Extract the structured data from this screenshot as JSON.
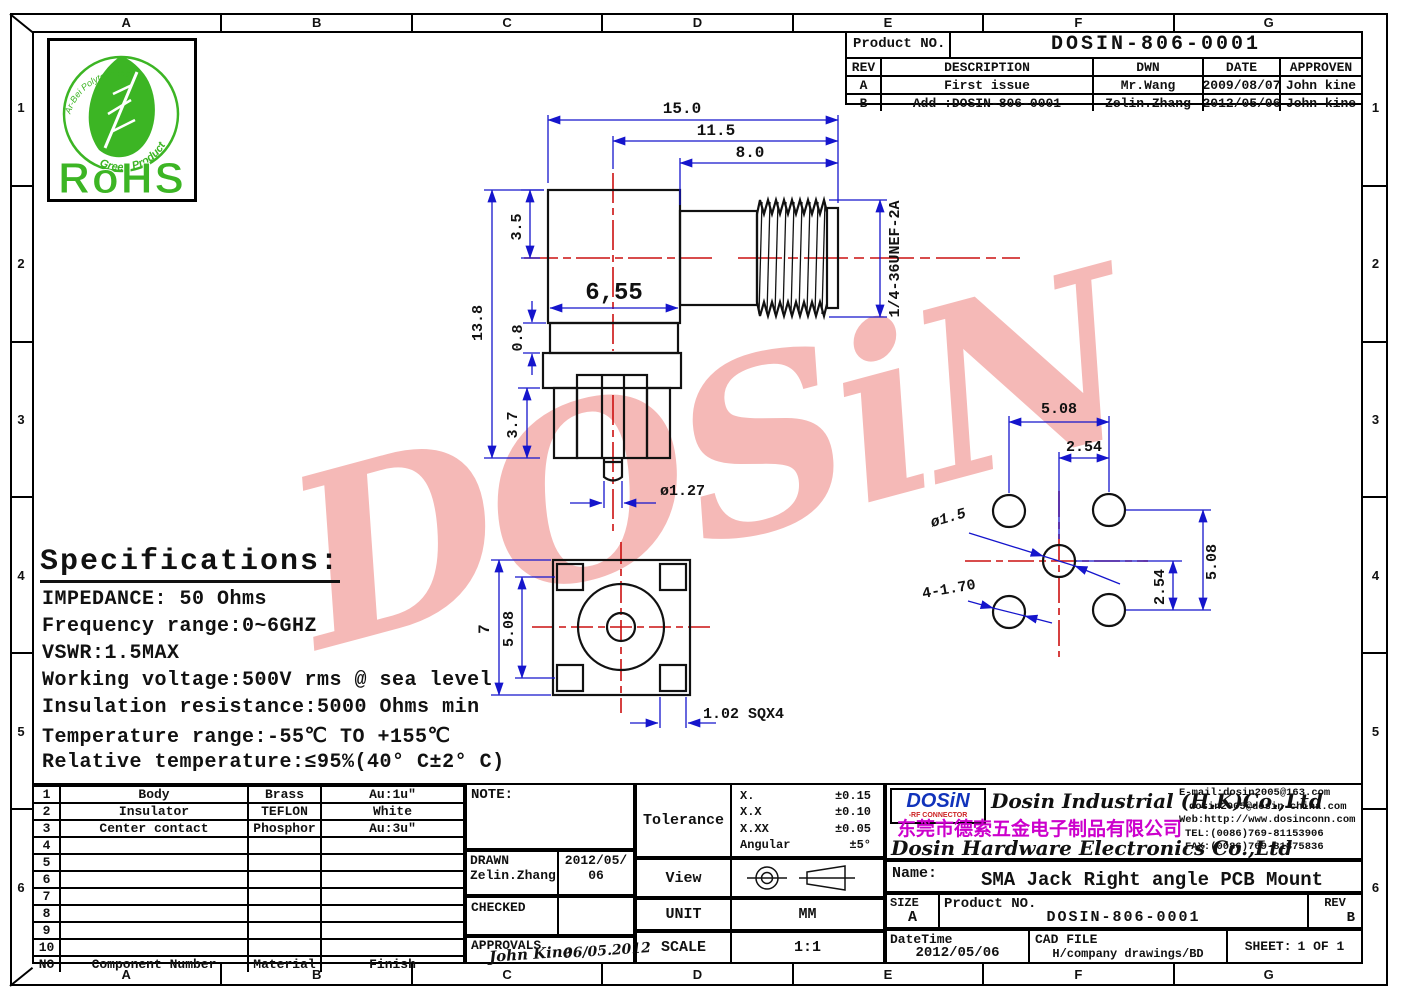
{
  "grid": {
    "columns": [
      "A",
      "B",
      "C",
      "D",
      "E",
      "F",
      "G"
    ],
    "rows": [
      "1",
      "2",
      "3",
      "4",
      "5",
      "6"
    ]
  },
  "revision_table": {
    "product_no_label": "Product NO.",
    "product_no": "DOSIN-806-0001",
    "headers": [
      "REV",
      "DESCRIPTION",
      "DWN",
      "DATE",
      "APPROVEN"
    ],
    "rows": [
      {
        "rev": "A",
        "description": "First issue",
        "dwn": "Mr.Wang",
        "date": "2009/08/07",
        "approven": "John kine"
      },
      {
        "rev": "B",
        "description": "Add :DOSIN-806-0001",
        "dwn": "Zelin.Zhang",
        "date": "2012/05/06",
        "approven": "John kine"
      }
    ]
  },
  "rohs": {
    "label": "RoHS",
    "arc_top": "Ar-Bei Polytech Inc.",
    "arc_bottom": "Green Product"
  },
  "watermark": "DOSiN",
  "specifications": {
    "title": "Specifications:",
    "lines": [
      "IMPEDANCE: 50 Ohms",
      "Frequency range:0~6GHZ",
      "VSWR:1.5MAX",
      "Working voltage:500V rms @ sea level",
      "Insulation resistance:5000 Ohms min",
      "Temperature range:-55℃ TO +155℃",
      "Relative temperature:≤95%(40° C±2° C)"
    ]
  },
  "dims": {
    "d150": "15.0",
    "d115": "11.5",
    "d80": "8.0",
    "d35": "3.5",
    "d655": "6,55",
    "d138": "13.8",
    "d08": "0.8",
    "d37": "3.7",
    "d127": "ø1.27",
    "thread": "1/4-36UNEF-2A",
    "b7": "7",
    "b508": "5.08",
    "bsq": "1.02 SQX4",
    "p508t": "5.08",
    "p254t": "2.54",
    "p508r": "5.08",
    "p254r": "2.54",
    "phole": "ø1.5",
    "pholes": "4-1.70"
  },
  "parts_table": {
    "header": {
      "no": "NO",
      "component": "Component Number",
      "material": "Material",
      "finish": "Finish"
    },
    "rows": [
      {
        "no": "1",
        "component": "Body",
        "material": "Brass",
        "finish": "Au:1u\""
      },
      {
        "no": "2",
        "component": "Insulator",
        "material": "TEFLON",
        "finish": "White"
      },
      {
        "no": "3",
        "component": "Center contact",
        "material": "Phosphor",
        "finish": "Au:3u\""
      },
      {
        "no": "4",
        "component": "",
        "material": "",
        "finish": ""
      },
      {
        "no": "5",
        "component": "",
        "material": "",
        "finish": ""
      },
      {
        "no": "6",
        "component": "",
        "material": "",
        "finish": ""
      },
      {
        "no": "7",
        "component": "",
        "material": "",
        "finish": ""
      },
      {
        "no": "8",
        "component": "",
        "material": "",
        "finish": ""
      },
      {
        "no": "9",
        "component": "",
        "material": "",
        "finish": ""
      },
      {
        "no": "10",
        "component": "",
        "material": "",
        "finish": ""
      }
    ]
  },
  "note_block": {
    "note_label": "NOTE:",
    "drawn_label": "DRAWN",
    "drawn_name": "Zelin.Zhang",
    "drawn_date_line1": "2012/05/",
    "drawn_date_line2": "06",
    "checked_label": "CHECKED",
    "approvals_label": "APPROVALS",
    "signature": "John Kine",
    "signature_date": "06/05.2012"
  },
  "tolerance_block": {
    "label": "Tolerance",
    "rows": [
      {
        "name": "X.",
        "value": "±0.15"
      },
      {
        "name": "X.X",
        "value": "±0.10"
      },
      {
        "name": "X.XX",
        "value": "±0.05"
      },
      {
        "name": "Angular",
        "value": "±5°"
      }
    ],
    "view_label": "View",
    "unit_label": "UNIT",
    "unit_value": "MM",
    "scale_label": "SCALE",
    "scale_value": "1:1"
  },
  "company_block": {
    "logo_text": "DOSiN",
    "logo_sub": "-RF CONNECTOR",
    "name_en1": "Dosin Industrial (H.K)Co.,Ltd",
    "name_cn": "东莞市德索五金电子制品有限公司",
    "name_en2": "Dosin Hardware Electronics Co.,Ltd",
    "contacts": [
      "E-mail:dosin2005@163.com",
      "dosin2005@dosin-china.com",
      "Web:http://www.dosinconn.com",
      "TEL:(0086)769-81153906",
      "FAX:(0086)769-81875836"
    ],
    "name_label": "Name:",
    "product_name": "SMA Jack Right angle PCB Mount"
  },
  "title_block": {
    "size_label": "SIZE",
    "size_value": "A",
    "product_no_label": "Product NO.",
    "product_no": "DOSIN-806-0001",
    "rev_label": "REV",
    "rev_value": "B",
    "datetime_label": "DateTime",
    "datetime_value": "2012/05/06",
    "cad_label": "CAD FILE",
    "cad_value": "H/company drawings/BD",
    "sheet_label": "SHEET:",
    "sheet_value": "1 OF 1"
  },
  "colors": {
    "dimension_blue": "#1515cc",
    "centerline_red": "#cc1111",
    "watermark_pink": "#f5b9b7",
    "rohs_green": "#3cb524",
    "logo_blue": "#1133bb",
    "chinese_magenta": "#cc00cc"
  }
}
